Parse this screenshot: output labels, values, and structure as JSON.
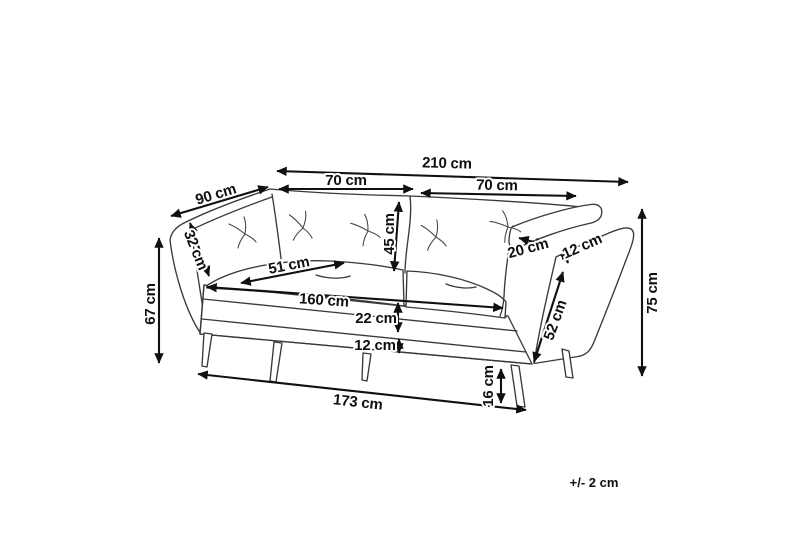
{
  "diagram": {
    "kind": "sofa dimension drawing",
    "background_color": "#ffffff",
    "ink_color": "#101010",
    "sofa_line_color": "#3a3a3a",
    "tolerance_note": "+/- 2 cm",
    "dims": {
      "total_width": "210 cm",
      "back_section_left": "70 cm",
      "back_section_right": "70 cm",
      "depth": "90 cm",
      "back_cushion": "32 cm",
      "backrest_height": "45 cm",
      "arm_height_left": "67 cm",
      "seat_cushion_depth": "51 cm",
      "seat_width": "160 cm",
      "seat_cushion_thickness": "22 cm",
      "base_rail": "12 cm",
      "base_width": "173 cm",
      "armrest_top_width": "20 cm",
      "armrest_thickness": "12 cm",
      "arm_slope_length": "52 cm",
      "total_height": "75 cm",
      "leg_height": "16 cm"
    }
  }
}
